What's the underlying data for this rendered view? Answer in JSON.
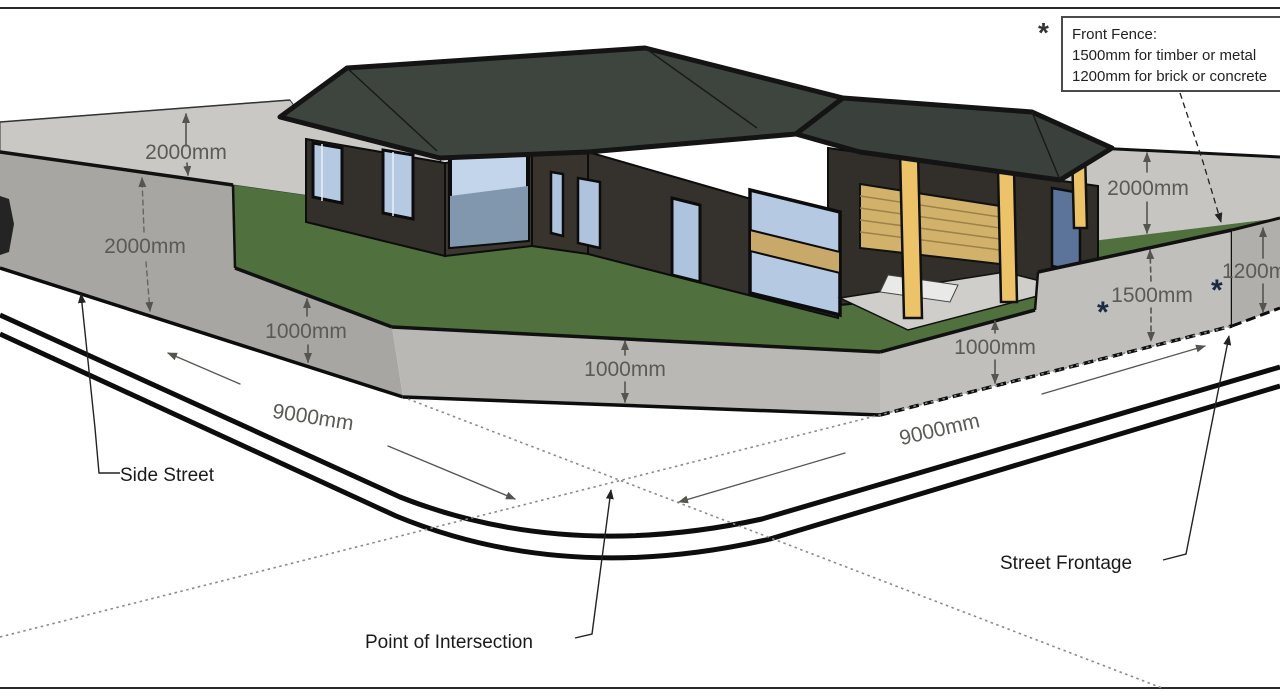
{
  "note_box": {
    "marker": "*",
    "title": "Front Fence:",
    "option_timber": "1500mm for timber or metal",
    "option_masonry": "1200mm for brick or concrete"
  },
  "street_labels": {
    "side_street": "Side Street",
    "street_frontage": "Street Frontage",
    "point_of_intersection": "Point of Intersection"
  },
  "fence_dimensions": {
    "rear_left_height": "2000mm",
    "side_tall_height": "2000mm",
    "side_low_height": "1000mm",
    "corner_splay_height": "1000mm",
    "front_low_height": "1000mm",
    "front_timber_height": "1500mm",
    "front_masonry_height": "1200mm",
    "rear_right_height": "2000mm",
    "side_boundary_length": "9000mm",
    "front_boundary_length": "9000mm",
    "asterisk": "*"
  },
  "colors": {
    "lawn": "#50703d",
    "fence_side": "#a7a6a2",
    "fence_splay": "#b9b8b4",
    "fence_front": "#c0bfbb",
    "fence_rear_band": "#c9c8c4",
    "roof": "#3e453f",
    "house_wall": "#35312c",
    "window_glass": "#b5c9e2",
    "porch_post": "#ecc368",
    "garage_door": "#d2b26b",
    "kerb": "#0d0d0d",
    "dim_text": "#5b5a55"
  }
}
